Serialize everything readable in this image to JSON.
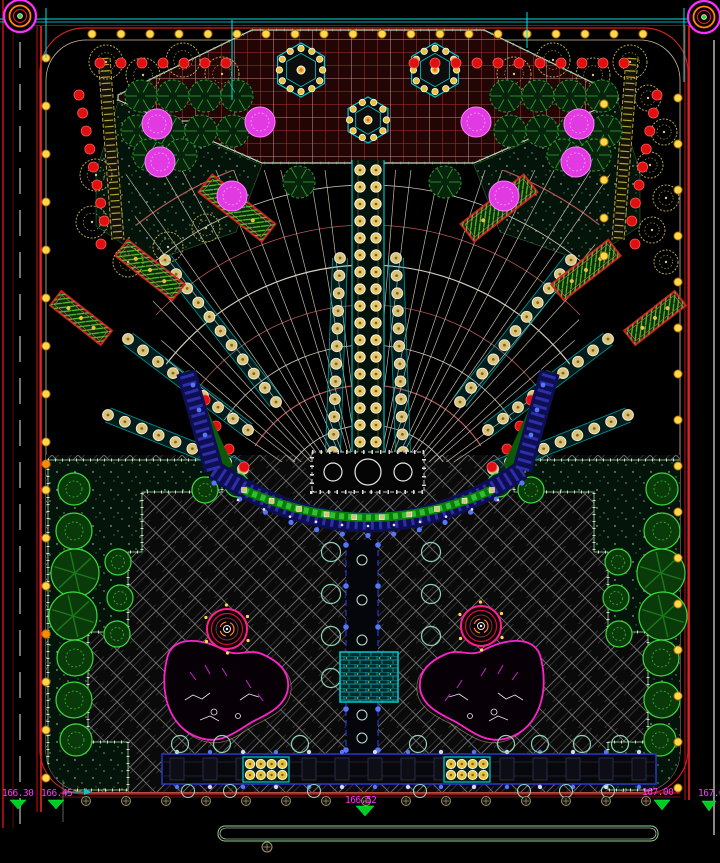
{
  "drawing": {
    "kind": "landscape-site-plan",
    "width": 720,
    "height": 863,
    "background": "#000000"
  },
  "colors": {
    "road_red": "#cc1111",
    "bright_red": "#ff2222",
    "dark_red_line": "#6a1414",
    "cyan_line": "#00e0e0",
    "border_tan": "#c8b89a",
    "grid_red": "#b23030",
    "grid_bg": "#220606",
    "grid_white": "#d8d8d8",
    "tree_tan": "#b5a44b",
    "tree_green_dark": "#2a9a2a",
    "tree_green_bright": "#3adb3a",
    "tree_magenta": "#e23ae2",
    "shrub_red": "#e01010",
    "light_yellow": "#ffd84d",
    "light_orange": "#ff8c00",
    "navy_band": "#0e0e52",
    "navy_dash": "#2e2ea8",
    "blue_dot": "#5577ff",
    "hedge_green": "#0b7a0b",
    "pond_magenta": "#ff22cc",
    "spiral_pink": "#ff2090",
    "label_magenta": "#ff35ff",
    "triangle_green": "#00cc22",
    "pool_cyan": "#00cccc",
    "bed_border": "#9fdf9f",
    "herringbone_gray": "#8f8f8f"
  },
  "elevations": [
    {
      "value": "166.30"
    },
    {
      "value": "166.45"
    },
    {
      "value": "166.52"
    },
    {
      "value": "167.00"
    },
    {
      "value": "167.0"
    }
  ],
  "legend_markers": [
    {
      "x": 182,
      "y": 121,
      "size": 13
    },
    {
      "x": 541,
      "y": 121,
      "size": 13
    }
  ],
  "corner_circles": [
    {
      "cx": 20,
      "cy": 16
    },
    {
      "cx": 704,
      "cy": 17
    }
  ],
  "survey_ticks": {
    "xs": [
      46,
      232,
      527,
      684
    ],
    "y_ranges": [
      [
        8,
        58
      ],
      [
        20,
        100
      ],
      [
        12,
        48
      ],
      [
        8,
        82
      ]
    ]
  },
  "plaza": {
    "polygon": "252,30 484,30 618,95 618,100 474,163 262,163 118,100 118,95",
    "hexagons": [
      {
        "cx": 301,
        "cy": 70,
        "r": 27,
        "dots": 12
      },
      {
        "cx": 435,
        "cy": 70,
        "r": 27,
        "dots": 12
      },
      {
        "cx": 368,
        "cy": 120,
        "r": 23,
        "dots": 10
      }
    ]
  },
  "fan": {
    "cx": 368,
    "cy": 520,
    "ray_angles": [
      34,
      41,
      48,
      55,
      62,
      69,
      76,
      83,
      90,
      97,
      104,
      111,
      118,
      125,
      132,
      139,
      146
    ],
    "arc_radii": [
      95,
      135,
      175,
      215,
      255,
      295,
      335,
      375
    ]
  },
  "axis": {
    "x": 352,
    "w": 32,
    "y0": 160,
    "y1": 455,
    "dot_cols": [
      360,
      376
    ],
    "dot_step": 17,
    "dot_r": 5.2
  },
  "planters": [
    {
      "cx": 237,
      "cy": 208,
      "w": 80,
      "h": 22,
      "rot": 38
    },
    {
      "cx": 150,
      "cy": 270,
      "w": 72,
      "h": 20,
      "rot": 38
    },
    {
      "cx": 81,
      "cy": 318,
      "w": 64,
      "h": 18,
      "rot": 38
    },
    {
      "cx": 499,
      "cy": 208,
      "w": 80,
      "h": 22,
      "rot": -38
    },
    {
      "cx": 586,
      "cy": 270,
      "w": 72,
      "h": 20,
      "rot": -38
    },
    {
      "cx": 655,
      "cy": 318,
      "w": 64,
      "h": 18,
      "rot": -38
    }
  ],
  "ramps": [
    {
      "x1": 276,
      "y1": 402,
      "x2": 165,
      "y2": 260
    },
    {
      "x1": 248,
      "y1": 430,
      "x2": 128,
      "y2": 339
    },
    {
      "x1": 243,
      "y1": 469,
      "x2": 108,
      "y2": 415
    },
    {
      "x1": 460,
      "y1": 402,
      "x2": 571,
      "y2": 260
    },
    {
      "x1": 488,
      "y1": 430,
      "x2": 608,
      "y2": 339
    },
    {
      "x1": 493,
      "y1": 469,
      "x2": 628,
      "y2": 415
    },
    {
      "x1": 340,
      "y1": 258,
      "x2": 333,
      "y2": 452
    },
    {
      "x1": 396,
      "y1": 258,
      "x2": 403,
      "y2": 452
    }
  ],
  "trees": {
    "tan": [
      [
        106,
        62,
        17
      ],
      [
        143,
        75,
        17
      ],
      [
        183,
        60,
        17
      ],
      [
        222,
        74,
        17
      ],
      [
        96,
        175,
        16
      ],
      [
        92,
        222,
        16
      ],
      [
        128,
        262,
        15
      ],
      [
        168,
        247,
        15
      ],
      [
        206,
        228,
        14
      ],
      [
        630,
        62,
        17
      ],
      [
        593,
        75,
        17
      ],
      [
        553,
        60,
        17
      ],
      [
        514,
        74,
        17
      ],
      [
        648,
        98,
        13
      ],
      [
        664,
        132,
        13
      ],
      [
        650,
        165,
        13
      ],
      [
        666,
        198,
        13
      ],
      [
        652,
        230,
        13
      ],
      [
        666,
        262,
        12
      ]
    ],
    "green_dark": [
      [
        141,
        96
      ],
      [
        173,
        96
      ],
      [
        205,
        96
      ],
      [
        237,
        96
      ],
      [
        137,
        131
      ],
      [
        169,
        131
      ],
      [
        201,
        131
      ],
      [
        233,
        131
      ],
      [
        149,
        155
      ],
      [
        181,
        155
      ],
      [
        299,
        182
      ],
      [
        445,
        182
      ],
      [
        506,
        96
      ],
      [
        538,
        96
      ],
      [
        570,
        96
      ],
      [
        602,
        96
      ],
      [
        510,
        131
      ],
      [
        542,
        131
      ],
      [
        574,
        131
      ],
      [
        606,
        131
      ],
      [
        563,
        155
      ],
      [
        595,
        155
      ]
    ],
    "magenta": [
      [
        157,
        124
      ],
      [
        160,
        162
      ],
      [
        260,
        122
      ],
      [
        232,
        196
      ],
      [
        579,
        124
      ],
      [
        576,
        162
      ],
      [
        476,
        122
      ],
      [
        504,
        196
      ]
    ],
    "green_bright": [
      [
        74,
        489,
        16,
        0
      ],
      [
        74,
        531,
        18,
        0
      ],
      [
        75,
        573,
        24,
        1
      ],
      [
        73,
        616,
        24,
        1
      ],
      [
        75,
        658,
        18,
        0
      ],
      [
        74,
        700,
        18,
        0
      ],
      [
        76,
        740,
        16,
        0
      ],
      [
        118,
        562,
        13,
        0
      ],
      [
        120,
        598,
        13,
        0
      ],
      [
        117,
        634,
        13,
        0
      ],
      [
        205,
        490,
        13,
        0
      ],
      [
        237,
        485,
        12,
        0
      ],
      [
        662,
        489,
        16,
        0
      ],
      [
        662,
        531,
        18,
        0
      ],
      [
        661,
        573,
        24,
        1
      ],
      [
        663,
        616,
        24,
        1
      ],
      [
        661,
        658,
        18,
        0
      ],
      [
        662,
        700,
        18,
        0
      ],
      [
        660,
        740,
        16,
        0
      ],
      [
        618,
        562,
        13,
        0
      ],
      [
        616,
        598,
        13,
        0
      ],
      [
        619,
        634,
        13,
        0
      ],
      [
        531,
        490,
        13,
        0
      ],
      [
        499,
        485,
        12,
        0
      ]
    ]
  },
  "shrubs": {
    "rows": [
      {
        "y": 63,
        "x0": 100,
        "x1": 240,
        "step": 21
      },
      {
        "y": 63,
        "x0": 414,
        "x1": 634,
        "step": 21
      }
    ],
    "diagonals": [
      {
        "x": 79,
        "y": 95,
        "dx": 3.6,
        "dy": 18,
        "n": 8
      },
      {
        "x": 657,
        "y": 95,
        "dx": -3.6,
        "dy": 18,
        "n": 8
      }
    ],
    "points": [
      [
        101,
        244
      ],
      [
        635,
        244
      ],
      [
        205,
        400
      ],
      [
        216,
        426
      ],
      [
        229,
        449
      ],
      [
        244,
        467
      ],
      [
        531,
        400
      ],
      [
        520,
        426
      ],
      [
        507,
        449
      ],
      [
        492,
        467
      ]
    ]
  },
  "lights": {
    "columns": [
      {
        "x": 46,
        "y0": 58,
        "y1": 790,
        "step": 48
      },
      {
        "x": 678,
        "y0": 98,
        "y1": 790,
        "step": 46
      },
      {
        "x": 604,
        "y0": 104,
        "y1": 256,
        "step": 38
      }
    ],
    "rows": [
      {
        "y": 34,
        "x0": 92,
        "x1": 660,
        "step": 29
      }
    ],
    "orange": [
      [
        46,
        464
      ],
      [
        46,
        634
      ]
    ]
  },
  "stage": {
    "x": 312,
    "y": 452,
    "w": 112,
    "h": 40,
    "circles": [
      [
        333,
        472,
        9
      ],
      [
        368,
        472,
        13
      ],
      [
        403,
        472,
        9
      ]
    ]
  },
  "amphitheater": {
    "hedge": "M244,490 Q368,545 492,490",
    "band": "M214,470 Q368,575 522,470",
    "wing_left": "M214,470 L186,372",
    "wing_right": "M522,470 L550,372",
    "green_wing_left": "M184,372 L228,468",
    "green_wing_right": "M552,372 L508,468"
  },
  "lower_axis": {
    "x0": 346,
    "x1": 378,
    "y0": 540,
    "y1": 754,
    "side_circles_x": [
      331,
      431
    ],
    "side_circles_y": [
      552,
      594,
      636,
      678
    ],
    "mid_circles_y": [
      560,
      600,
      640,
      715,
      738
    ]
  },
  "pool": {
    "x": 340,
    "y": 652,
    "w": 58,
    "h": 50
  },
  "ponds": [
    {
      "mirror": false
    },
    {
      "mirror": true,
      "axis": 708
    }
  ],
  "spirals": [
    {
      "cx": 227,
      "cy": 629
    },
    {
      "cx": 481,
      "cy": 626
    }
  ],
  "pergola": {
    "x0": 162,
    "x1": 656,
    "y": 754,
    "h": 30,
    "post_step": 33,
    "grids": [
      {
        "x": 243,
        "y": 757,
        "w": 46,
        "h": 25
      },
      {
        "x": 444,
        "y": 757,
        "w": 46,
        "h": 25
      }
    ],
    "trees_above": [
      180,
      222,
      300,
      418,
      506,
      540,
      582,
      620
    ],
    "trees_below": [
      188,
      230,
      314,
      420,
      524,
      566,
      608
    ]
  },
  "survey_row": {
    "y": 801,
    "x0": 86,
    "x1": 646,
    "step": 40
  },
  "bottom_bar": {
    "x": 218,
    "y": 826,
    "w": 440,
    "h": 15,
    "circle": [
      267,
      847
    ]
  }
}
